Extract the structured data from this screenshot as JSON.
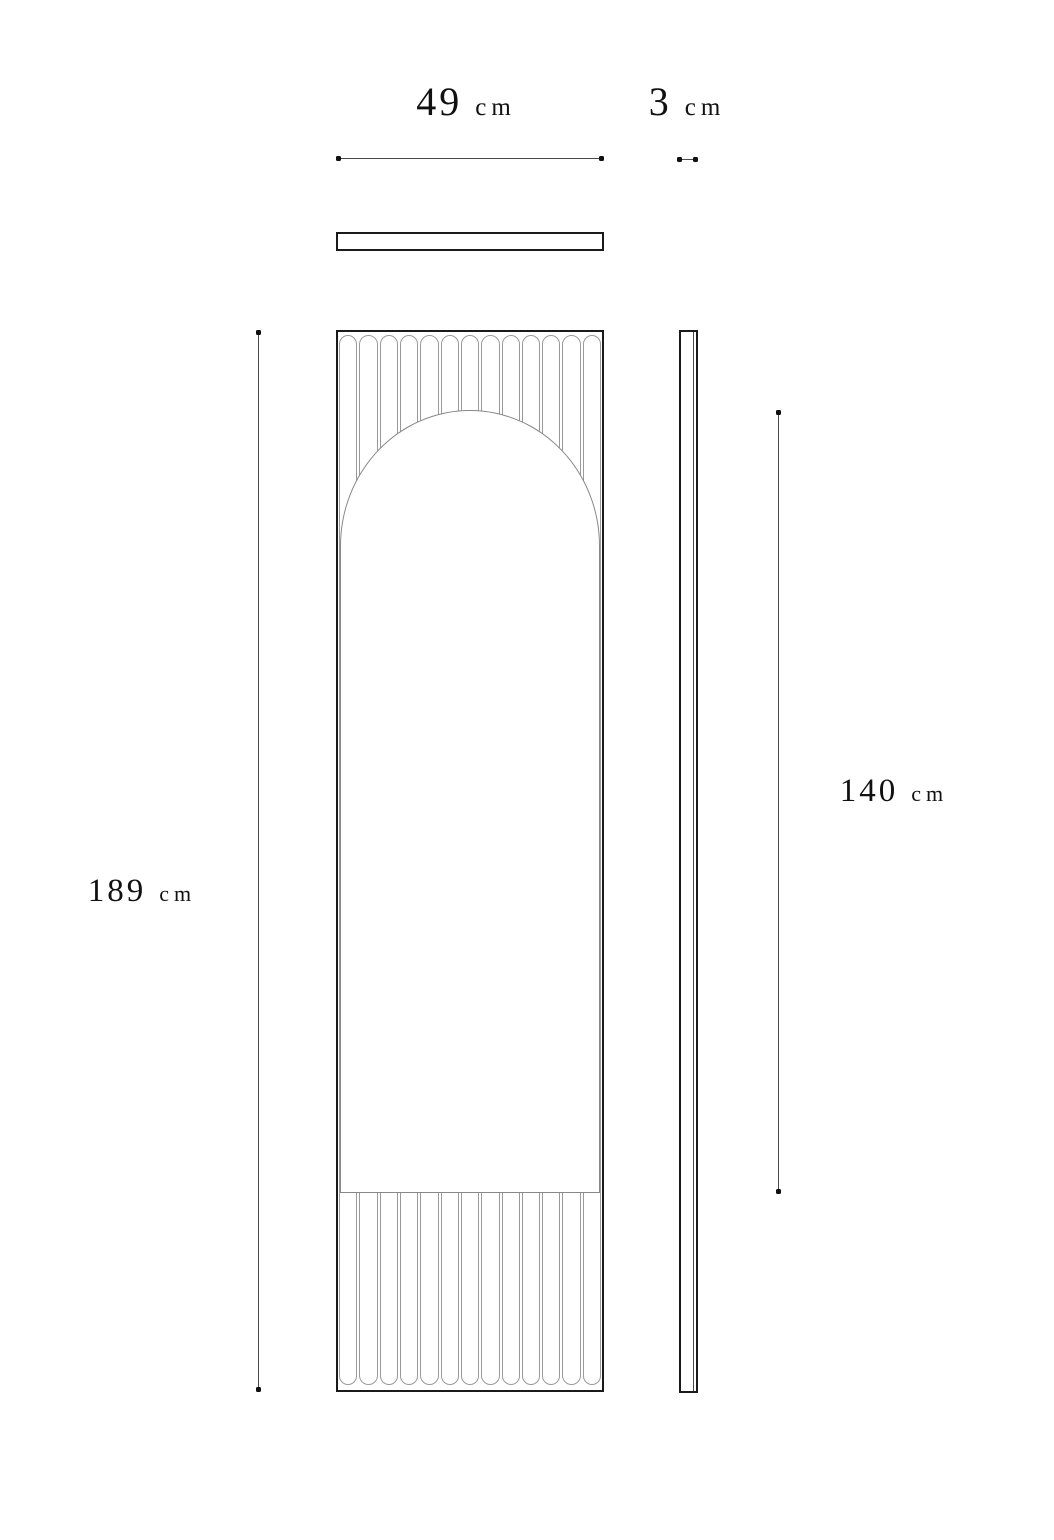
{
  "labels": {
    "width": {
      "value": "49",
      "unit": "cm"
    },
    "depth": {
      "value": "3",
      "unit": "cm"
    },
    "overall_height": {
      "value": "189",
      "unit": "cm"
    },
    "mirror_height": {
      "value": "140",
      "unit": "cm"
    }
  },
  "diagram": {
    "flute_count": 13,
    "colors": {
      "background": "#ffffff",
      "text": "#111111",
      "outline": "#1a1a1a",
      "flute_line": "#9a9a9a",
      "mirror_line": "#888888",
      "dim_line": "#4a4a4a",
      "dot": "#111111"
    }
  }
}
